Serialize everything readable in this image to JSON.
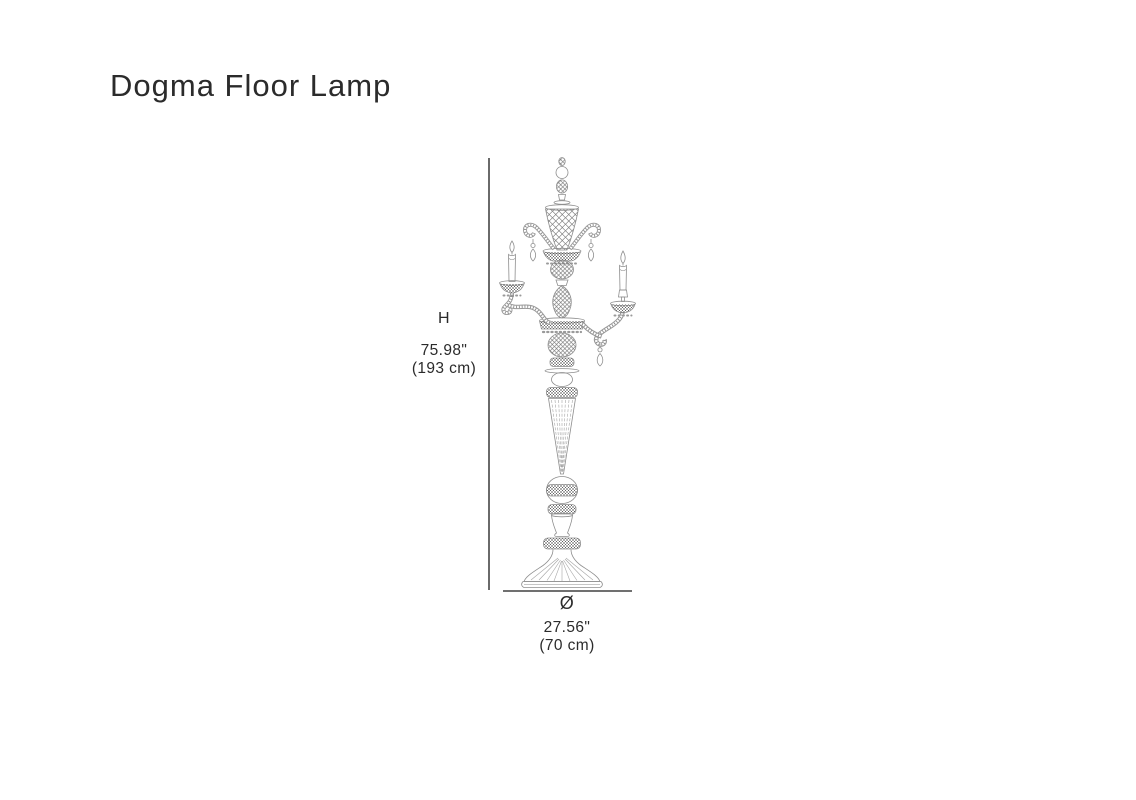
{
  "page": {
    "title": "Dogma Floor Lamp",
    "background": "#ffffff"
  },
  "dimensions": {
    "height": {
      "label": "H",
      "inches": "75.98\"",
      "metric": "(193 cm)"
    },
    "diameter": {
      "symbol": "Ø",
      "inches": "27.56\"",
      "metric": "(70 cm)"
    }
  },
  "drawing": {
    "subject": "two-arm candelabra crystal floor lamp, front elevation technical line drawing",
    "colors": {
      "text": "#2b2b2b",
      "dimension_line": "#1a1a1a",
      "sketch_stroke": "#8e8e8e",
      "sketch_dense": "#666666"
    }
  }
}
